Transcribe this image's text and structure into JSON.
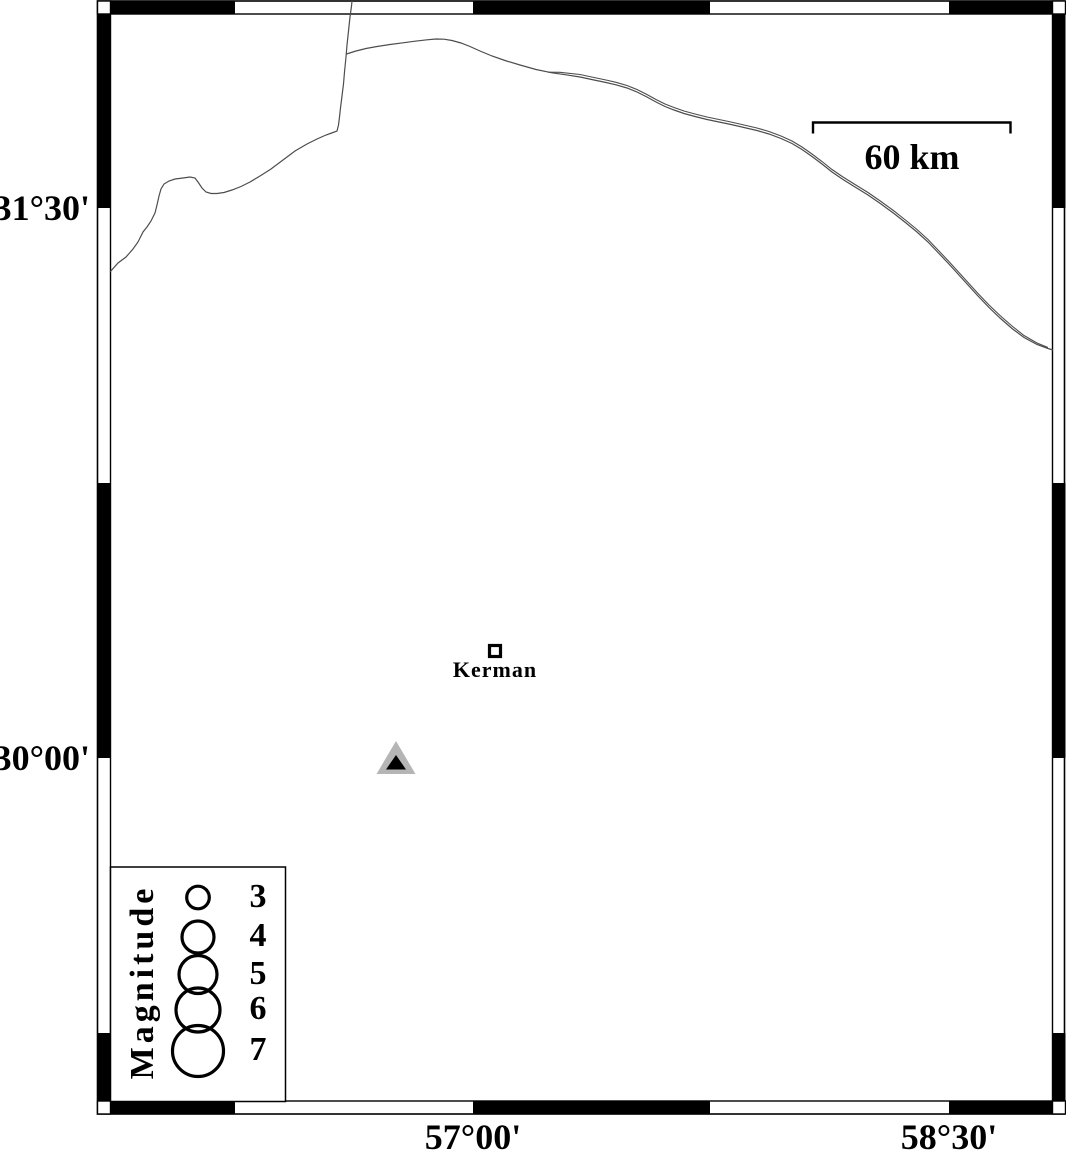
{
  "figure": {
    "axis": {
      "lat": [
        "31°30'",
        "30°00'"
      ],
      "lon": [
        "57°00'",
        "58°30'"
      ]
    },
    "scale_bar_label": "60 km",
    "city": "Kerman",
    "legend": {
      "title": "Magnitude",
      "entries": [
        {
          "magnitude": "3",
          "radius": 11.3
        },
        {
          "magnitude": "4",
          "radius": 16
        },
        {
          "magnitude": "5",
          "radius": 19
        },
        {
          "magnitude": "6",
          "radius": 22
        },
        {
          "magnitude": "7",
          "radius": 25.5
        }
      ]
    },
    "colors": {
      "frame": "#000000",
      "river": "#4d4d4d",
      "station_halo": "#b5b5b5",
      "station_core": "#000000"
    }
  }
}
